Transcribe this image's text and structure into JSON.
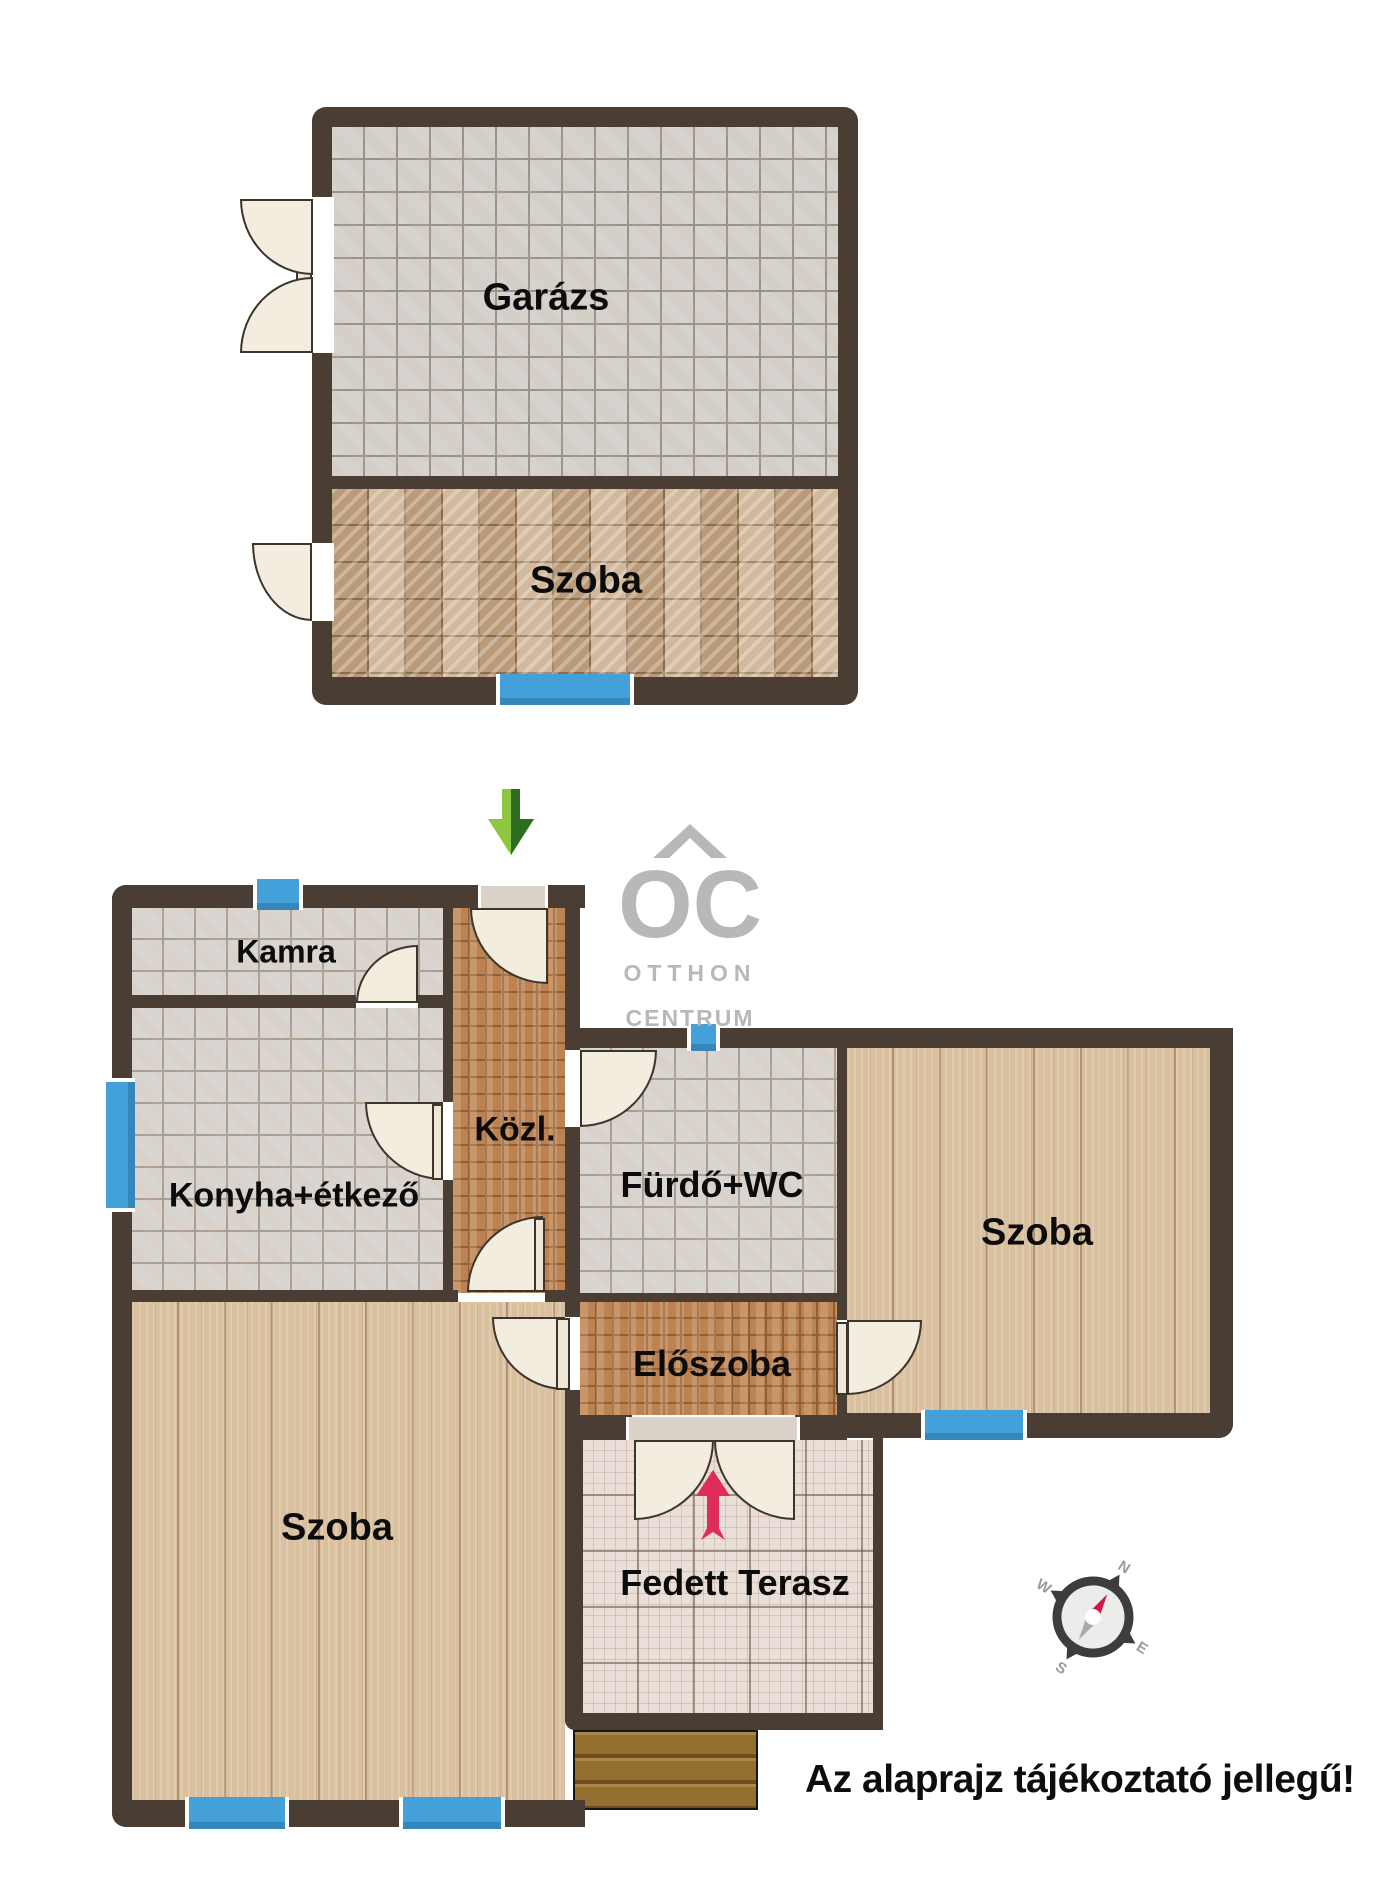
{
  "upper_building": {
    "garage_label": "Garázs",
    "room_label": "Szoba"
  },
  "house": {
    "kamra": "Kamra",
    "konyha": "Konyha+étkező",
    "kozl": "Közl.",
    "furdo": "Fürdő+WC",
    "szoba_right": "Szoba",
    "eloszoba": "Előszoba",
    "szoba_left": "Szoba",
    "terasz": "Fedett Terasz"
  },
  "watermark": {
    "logo": "OC",
    "line1": "OTTHON",
    "line2": "CENTRUM"
  },
  "compass": {
    "n": "N",
    "e": "E",
    "s": "S",
    "w": "W"
  },
  "disclaimer": "Az alaprajz tájékoztató jellegű!",
  "icons": {
    "entrance_direction": "green-arrow-down",
    "main_entrance": "pink-arrow-up",
    "orientation": "compass-rose"
  },
  "colors": {
    "wall": "#4a3e34",
    "window_blue": "#43a0d8",
    "arrow_green_light": "#8dc63f",
    "arrow_green_dark": "#2e6d20",
    "arrow_pink": "#e02c5a",
    "watermark_gray": "#b5b5b5"
  }
}
